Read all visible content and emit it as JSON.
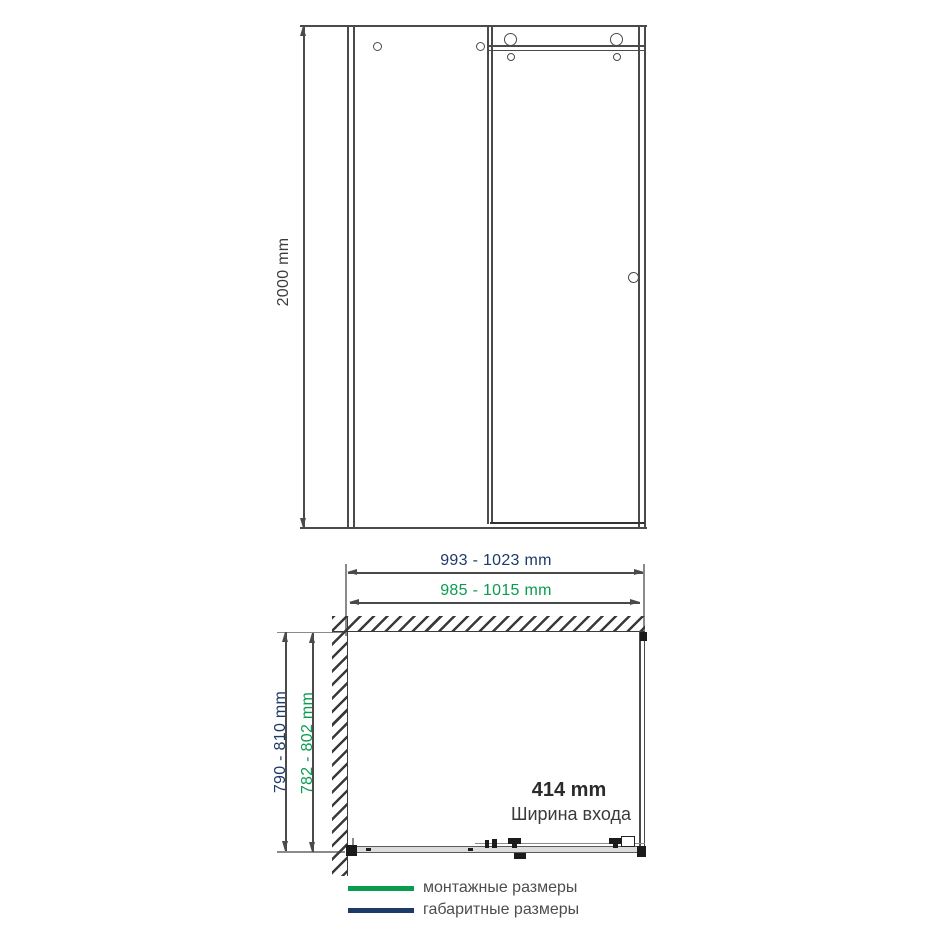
{
  "elevation": {
    "height_label": "2000 mm"
  },
  "plan": {
    "overall_width_label": "993 - 1023 mm",
    "mounting_width_label": "985 - 1015 mm",
    "overall_depth_label": "790 - 810 mm",
    "mounting_depth_label": "782 - 802 mm",
    "entry_width_value": "414 mm",
    "entry_width_caption": "Ширина входа"
  },
  "legend": {
    "mounting_label": "монтажные размеры",
    "overall_label": "габаритные размеры",
    "mounting_color": "#0a9b4f",
    "overall_color": "#1e3a66"
  },
  "colors": {
    "line_gray": "#4a4a4a",
    "hatch_dark": "#3a3a3a",
    "navy_text": "#1e3a66",
    "green_text": "#0a9b4f",
    "legend_text": "#4d4d4d"
  }
}
